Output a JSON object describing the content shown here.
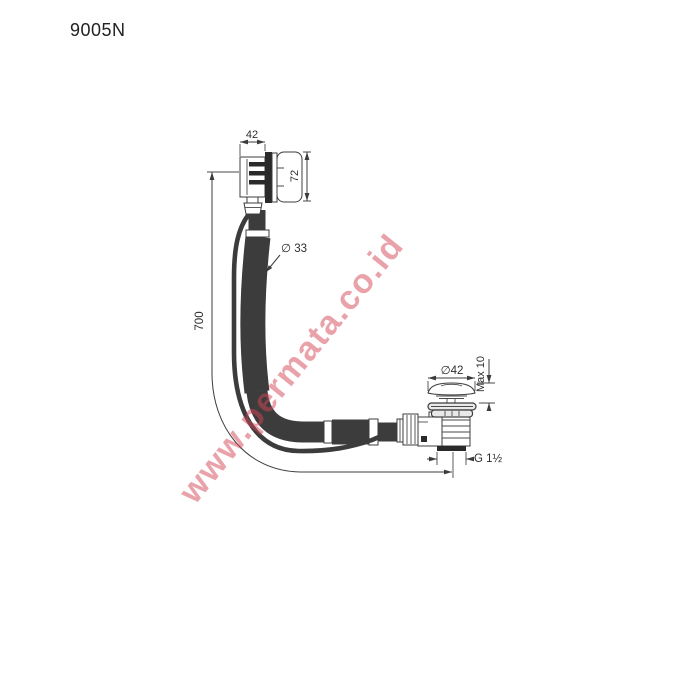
{
  "header": {
    "part_number": "9005N"
  },
  "dimensions": {
    "overflow_width": "42",
    "overflow_height": "72",
    "hose_diameter": "∅ 33",
    "hose_length": "700",
    "plug_diameter": "∅42",
    "plug_max_height": "Max 10",
    "outlet_thread": "G 1½"
  },
  "watermark": {
    "text": "www.permata.co.id",
    "color": "#d34654"
  },
  "colors": {
    "line": "#3c3c3c",
    "label_text": "#2e2e2e",
    "background": "#ffffff"
  }
}
